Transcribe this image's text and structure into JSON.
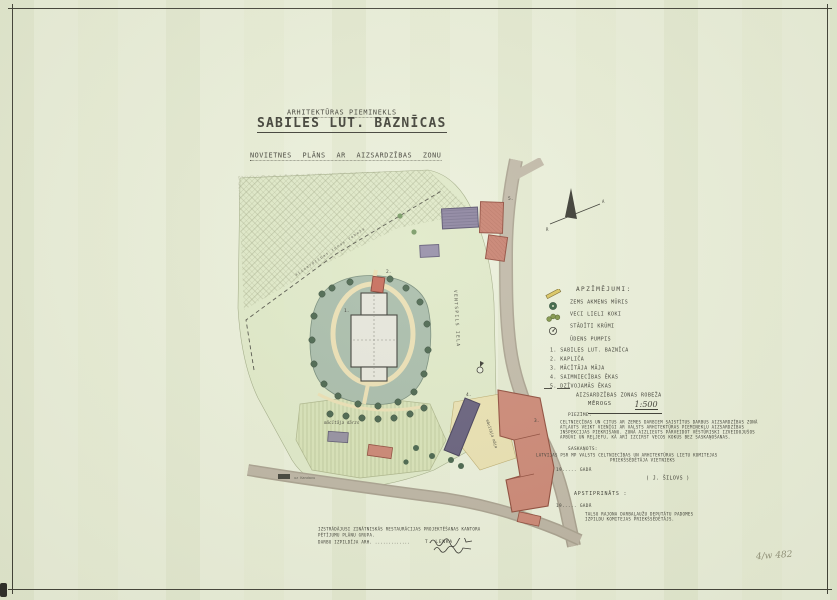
{
  "doc": {
    "supertitle": "ARHITEKTŪRAS PIEMINEKLS",
    "title": "SABILES LUT. BAZNĪCAS",
    "subtitle": "NOVIETNES PLĀNS AR AIZSARDZĪBAS ZONU",
    "corner_note": "4/w 482"
  },
  "map": {
    "street_label": "VENTSPILS IELA",
    "boundary_line_label": "aizsardzības zonas robeža",
    "garden_label": "mācītāja dārzs",
    "yard_label": "mācītāja māja",
    "road_stub_label": "uz Kandavu",
    "north_left": "R",
    "north_right": "A",
    "numbers": {
      "n1": "1.",
      "n2": "2.",
      "n3": "3.",
      "n4": "4.",
      "n5": "5."
    }
  },
  "legend": {
    "header": "APZĪMĒJUMI:",
    "symbols": [
      {
        "label": "ZEMS AKMENS MŪRIS"
      },
      {
        "label": "VECI LIELI KOKI"
      },
      {
        "label": "STĀDĪTI KRŪMI"
      },
      {
        "label": "ŪDENS PUMPIS"
      }
    ],
    "numbered": [
      "1. SABILES LUT. BAZNĪCA",
      "2. KAPLIČA",
      "3. MĀCĪTĀJA MĀJA",
      "4. SAIMNIECĪBAS ĒKAS",
      "5. DZĪVOJAMĀS ĒKAS"
    ],
    "boundary_label": "AIZSARDZĪBAS ZONAS ROBEŽA",
    "scale_label": "MĒROGS",
    "scale_value": "1:500"
  },
  "note": {
    "header": "PIEZĪME:",
    "line1": "CELTNIECĪBAS UN CITUS AR ZEMES DARBIEM SAISTĪTUS DARBUS AIZSARDZĪBAS ZONĀ",
    "line2": "ATĻAUTS VEIKT VIENĪGI AR VALSTS ARHITEKTŪRAS PIEMINEKĻU AIZSARDZĪBAS",
    "line3": "INSPEKCIJAS PIEKRIŠANU. ZONĀ AIZLIEGTS PĀRVEIDOT VĒSTURISKI IZVEIDOJUŠOS",
    "line4": "APBŪVI UN REĻJEFU, KĀ ARĪ IZCIRST VECOS KOKUS BEZ SASKAŅOŠANAS."
  },
  "approvals": {
    "agreed_header": "SASKAŅOTS:",
    "agreed_body1": "LATVIJAS PSR MP VALSTS CELTNIECĪBAS UN ARHITEKTŪRAS LIETU KOMITEJAS",
    "agreed_body2": "PRIEKŠSĒDĒTĀJA VIETNIEKS",
    "agreed_date": "19..... GADĀ",
    "agreed_signature": "( J. ŠILOVS )",
    "approved_header": "APSTIPRINĀTS :",
    "approved_date": "19..... GADĀ",
    "approved_body1": "TALSU RAJONA DARBAĻAUŽU DEPUTĀTU PADOMES",
    "approved_body2": "IZPILDU KOMITEJAS PRIEKŠSĒDĒTĀJS."
  },
  "credits": {
    "line1": "IZSTRĀDĀJUSI ZINĀTNISKĀS RESTAURĀCIJAS PROJEKTĒŠANAS KANTORA",
    "line2": "PĒTĪJUMU PLĀNU GRUPA.",
    "line3": "DARBU IZPILDĪJA ARH. .............",
    "name1": "T. LENKA"
  },
  "colors": {
    "paper": "#e9eed9",
    "ink": "#33332b",
    "park_green": "#dde7c5",
    "yard_green": "#a3b8a6",
    "tree_green": "#3f5c44",
    "building_red": "#c47a69",
    "building_purple": "#847b9a",
    "road_gray": "#b6ae9d",
    "path_cream": "#e9ddb0"
  }
}
